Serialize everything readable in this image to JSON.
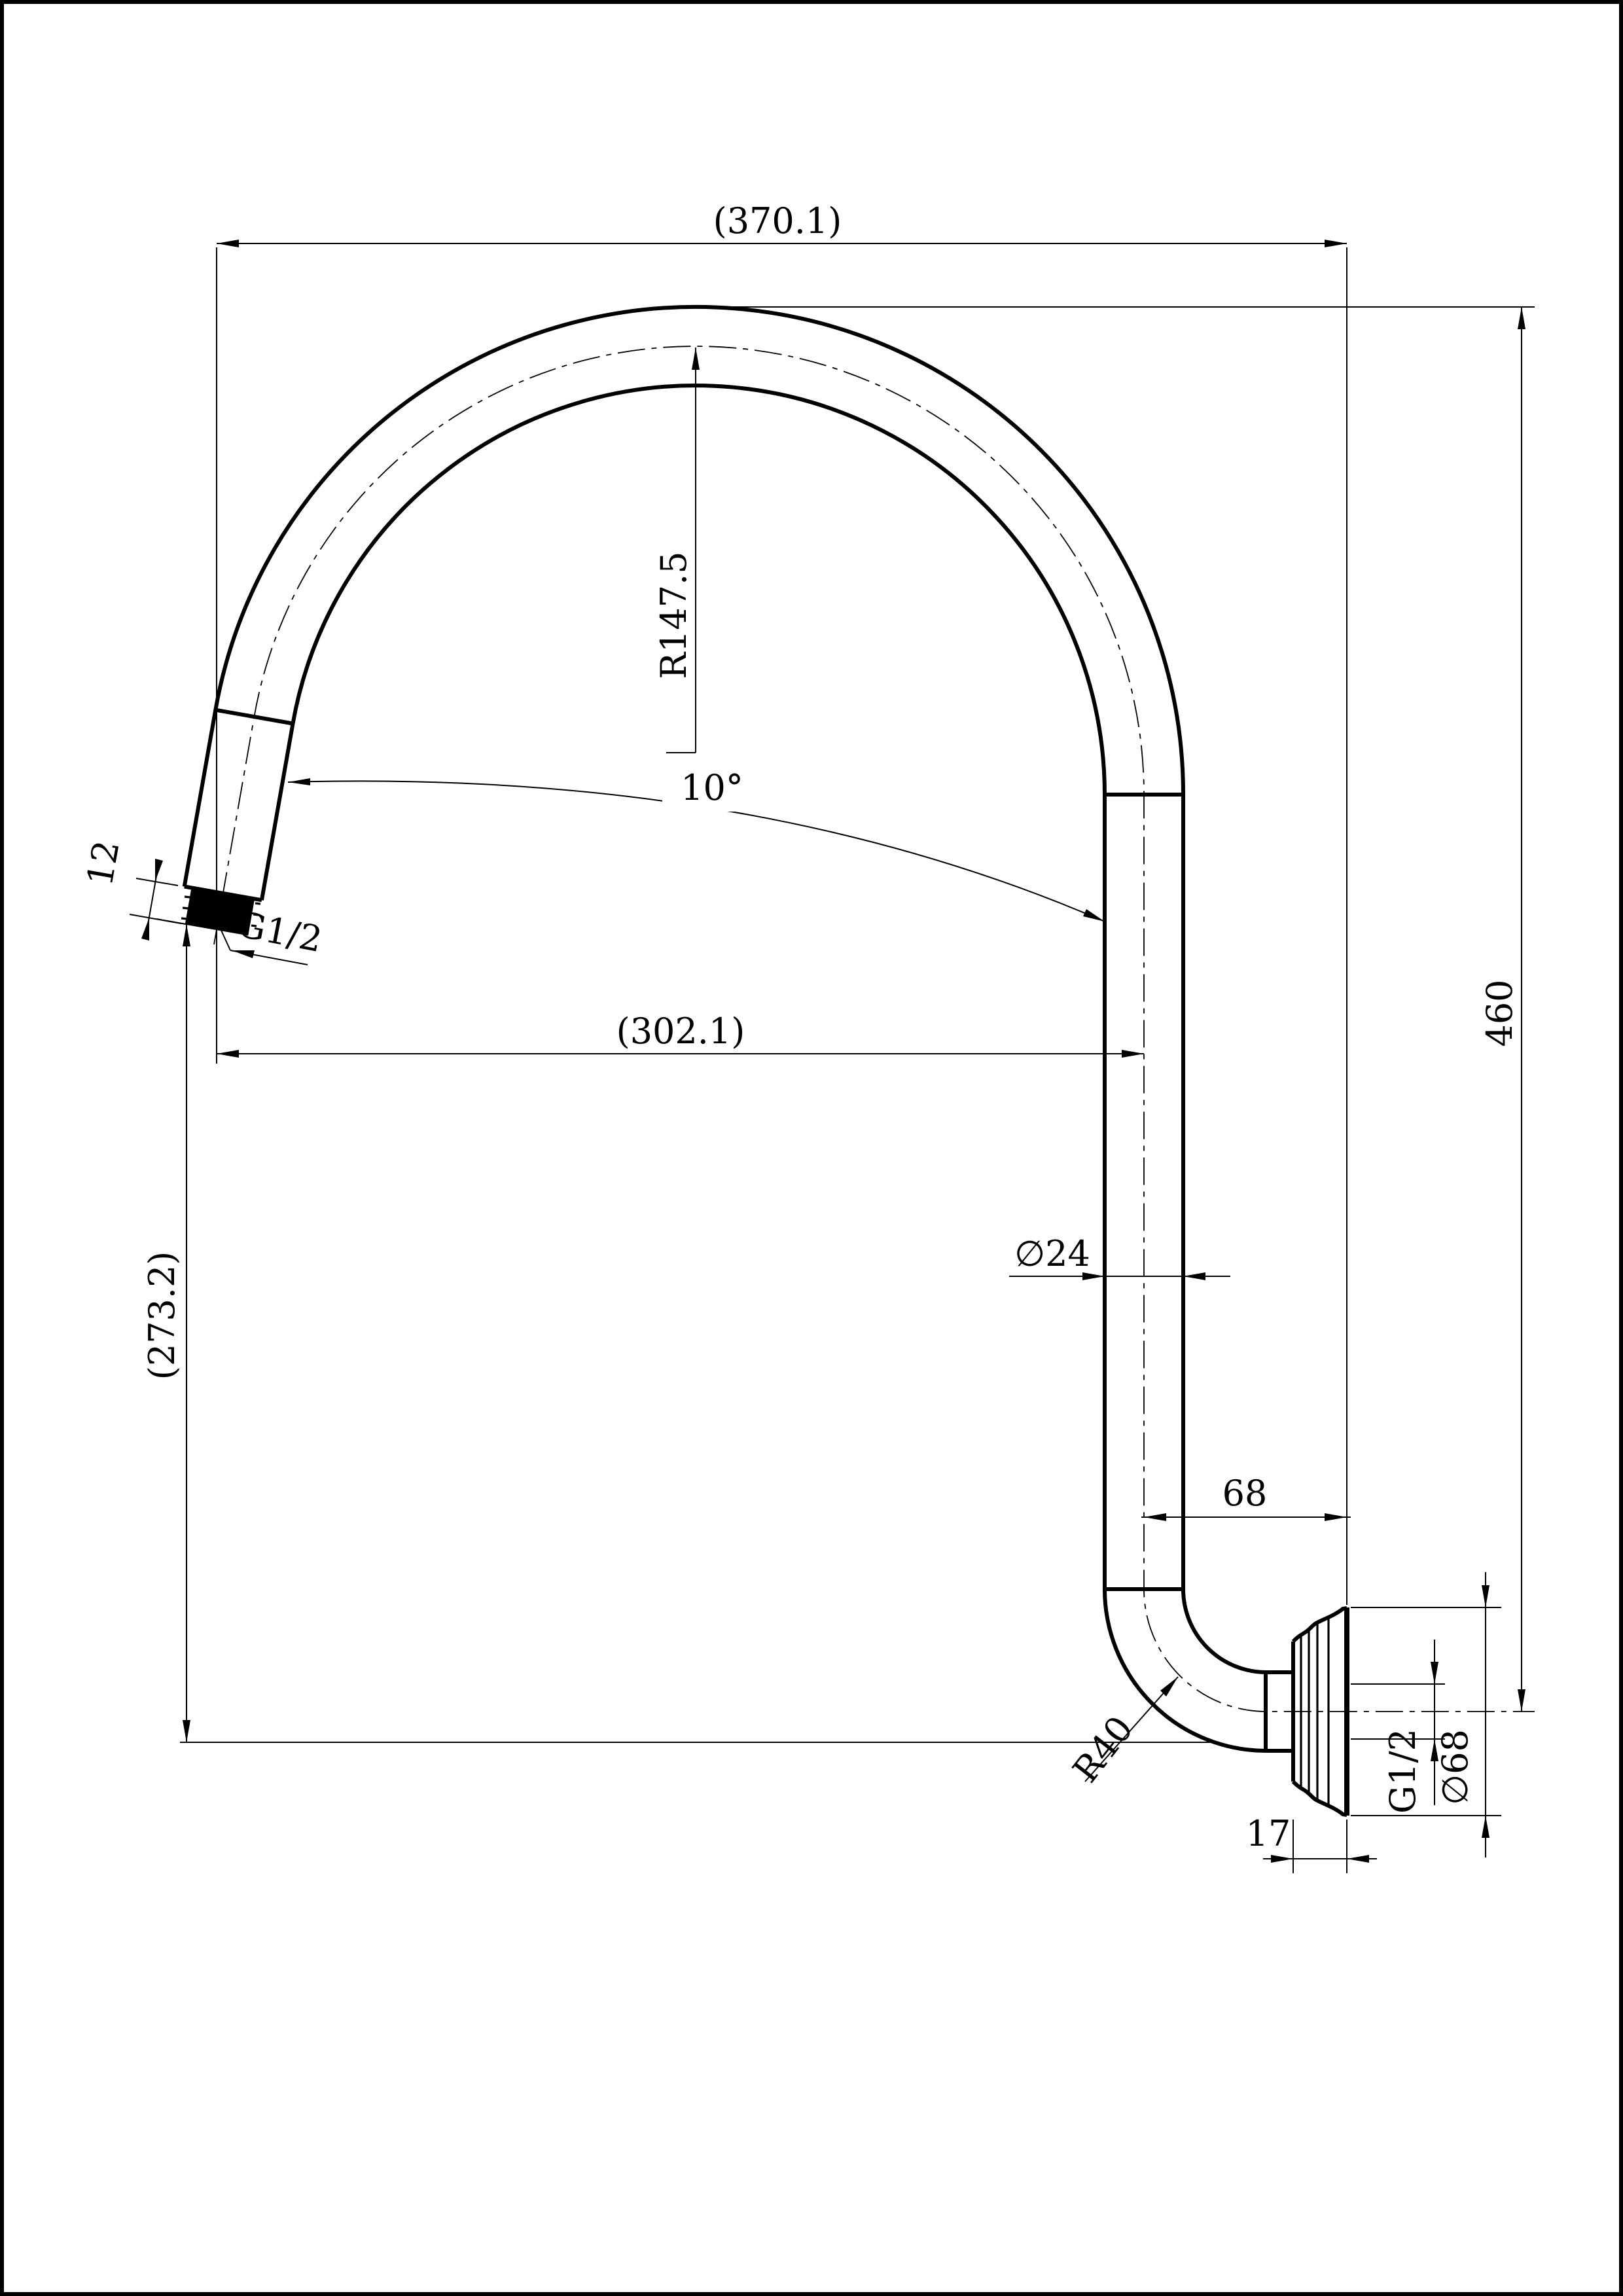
{
  "drawing": {
    "kind": "technical-drawing",
    "part": "gooseneck shower arm side elevation",
    "dims": {
      "overall_width": "(370.1)",
      "overall_height": "460",
      "main_bend_radius": "R147.5",
      "outlet_angle": "10°",
      "outlet_thread_length": "12",
      "outlet_thread": "G1/2",
      "reach_to_axis": "(302.1)",
      "drop_height": "(273.2)",
      "pipe_diameter": "∅24",
      "axis_to_wall": "68",
      "wall_bend_radius": "R40",
      "wall_thread": "G1/2",
      "flange_diameter": "∅68",
      "flange_depth": "17"
    }
  }
}
